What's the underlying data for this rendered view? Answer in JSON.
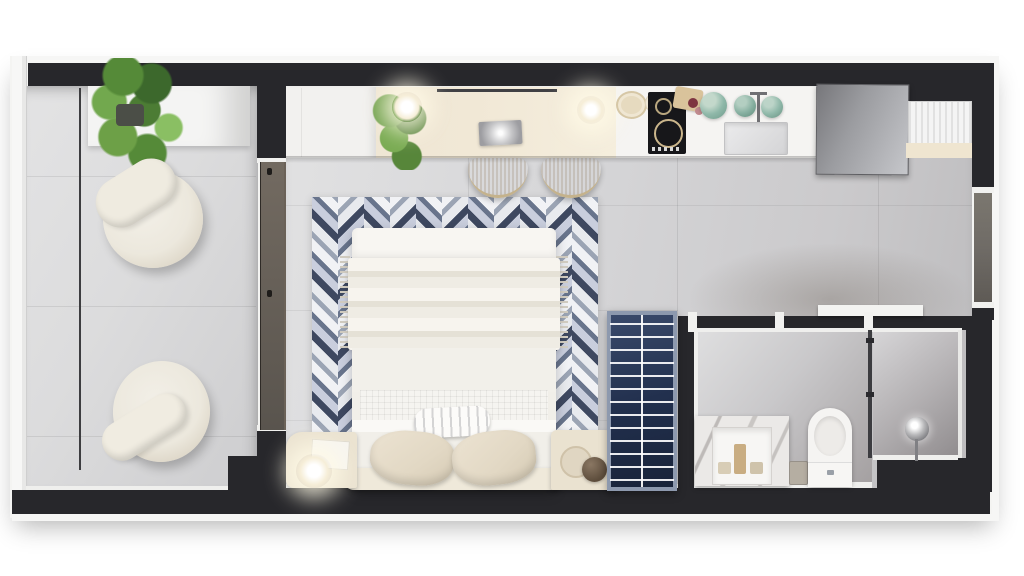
{
  "meta": {
    "description": "Top-down 3D architectural render of a studio apartment floor plan, no visible text",
    "canvas_width": 1024,
    "canvas_height": 576
  },
  "palette": {
    "wall": "#27272b",
    "trim": "#f4f4f2",
    "floor_main": "#d6d6d8",
    "floor_balcony": "#dcdcdd",
    "counter_white": "#f5f4f2",
    "counter_cream": "#f1e8d6",
    "fridge_steel": "#9b9ca0",
    "rug_dark": "#3e4860",
    "rug_slate": "#9ba4b4",
    "rug_light": "#f1f2f5",
    "wardrobe_navy": "#22304e",
    "wardrobe_frame": "#8d99ae",
    "teal_cookware": "#8fb8a9",
    "glass_door": "#4e443b",
    "entry_door": "#6f6b66",
    "bed_linen": "#f1efe9",
    "pillow_beige": "#e2d8c4",
    "nightstand_cream": "#ebe3d1",
    "chair_cream": "#ece8dd",
    "plant_green": "#558a38",
    "marble": "#ebe9e7",
    "bathroom_floor": "#c9c8ca"
  },
  "rooms": [
    {
      "id": "balcony"
    },
    {
      "id": "living-bedroom"
    },
    {
      "id": "kitchen"
    },
    {
      "id": "entry-hall"
    },
    {
      "id": "bathroom"
    },
    {
      "id": "shower"
    }
  ],
  "furniture": [
    "balcony-bench",
    "potted-plant",
    "pod-lounge-chair",
    "pod-lounge-chair",
    "sliding-glass-door",
    "desk-cabinet",
    "pendant-light",
    "desk-plant-light",
    "laptop",
    "counter-stool",
    "counter-stool",
    "plate-stack",
    "induction-cooktop",
    "cutting-board",
    "teal-cookware",
    "kitchen-sink",
    "kitchen-faucet",
    "refrigerator",
    "laundry-appliance",
    "chevron-rug",
    "double-bed",
    "lumbar-pillow",
    "pillow",
    "pillow",
    "headboard",
    "nightstand",
    "nightstand",
    "table-lamp",
    "open-wardrobe",
    "bathroom-vanity",
    "sink-basin",
    "toilet",
    "waste-bin",
    "shower-glass-partition",
    "shower-head",
    "entry-door"
  ]
}
